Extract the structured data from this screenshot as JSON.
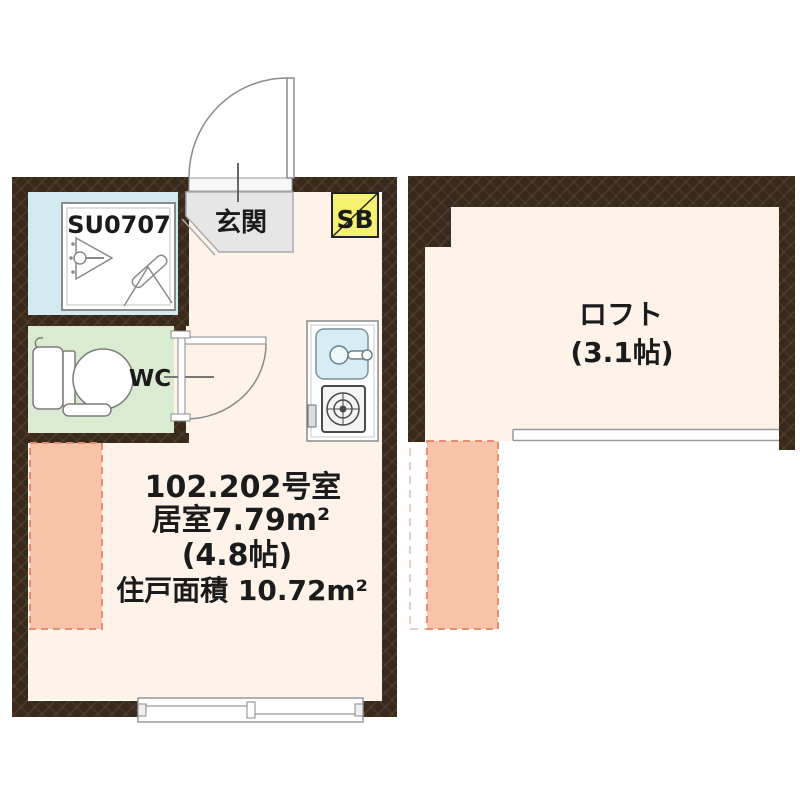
{
  "page": {
    "type": "Japanese apartment floor plan",
    "background": "#ffffff"
  },
  "colors": {
    "wall": "#38291b",
    "floor": "#fdf3e8",
    "entrance_floor": "#e6e6e6",
    "shower_room_floor": "#d2e9ef",
    "wc_floor": "#d9ecd2",
    "shoebox_fill": "#f5f170",
    "loft_footprint_fill": "#f9c3aa",
    "loft_footprint_dash": "#e49070",
    "fixture_line": "#888888"
  },
  "left_unit": {
    "entrance_label": "玄関",
    "shoebox_label": "SB",
    "shower_unit_label": "SU0707",
    "toilet_label": "WC",
    "room_info": [
      "102.202号室",
      "居室7.79m²",
      "(4.8帖)",
      "住戸面積 10.72m²"
    ]
  },
  "right_unit": {
    "loft_label": "ロフト",
    "loft_size_label": "(3.1帖)"
  }
}
